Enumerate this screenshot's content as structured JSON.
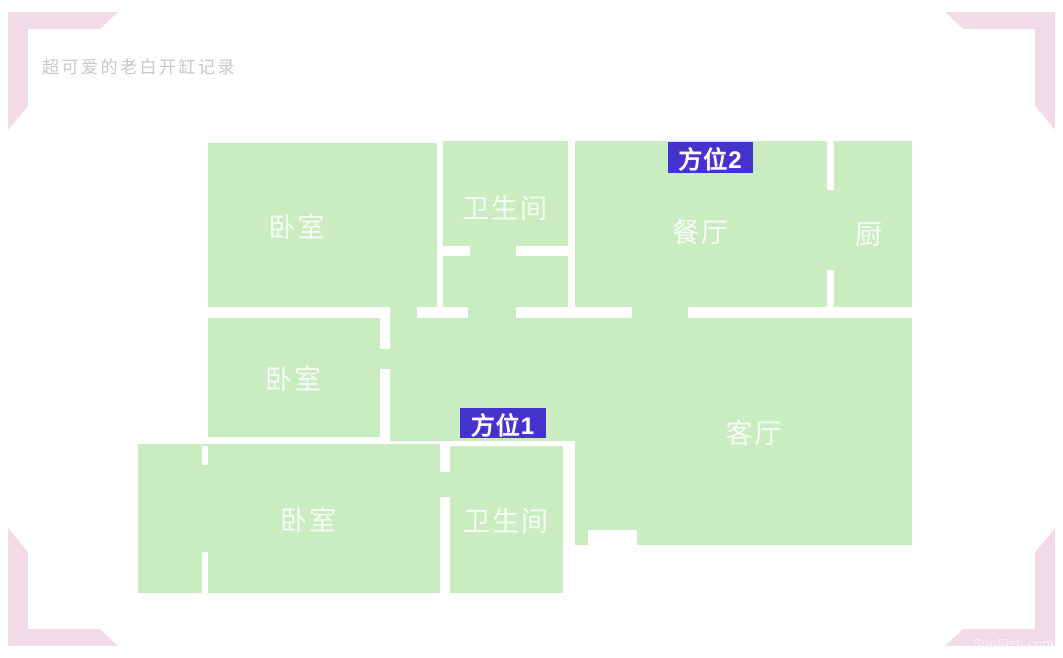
{
  "header": {
    "title": "超可爱的老白开缸记录"
  },
  "floorplan": {
    "rooms": {
      "bedroom1": {
        "label": "卧室"
      },
      "bathroom1": {
        "label": "卫生间"
      },
      "dining": {
        "label": "餐厅"
      },
      "kitchen": {
        "label": "厨"
      },
      "bedroom2": {
        "label": "卧室"
      },
      "living": {
        "label": "客厅"
      },
      "bedroom3": {
        "label": "卧室"
      },
      "bathroom2": {
        "label": "卫生间"
      }
    },
    "markers": {
      "position1": {
        "label": "方位1"
      },
      "position2": {
        "label": "方位2"
      }
    }
  },
  "watermark": {
    "text": "SunFish.com"
  },
  "colors": {
    "room_green": "#c9ecc1",
    "corner_pink": "#f2dbe7",
    "marker_blue": "#4433cb",
    "wall_white": "#ffffff",
    "title_gray": "#c8c8c8"
  }
}
